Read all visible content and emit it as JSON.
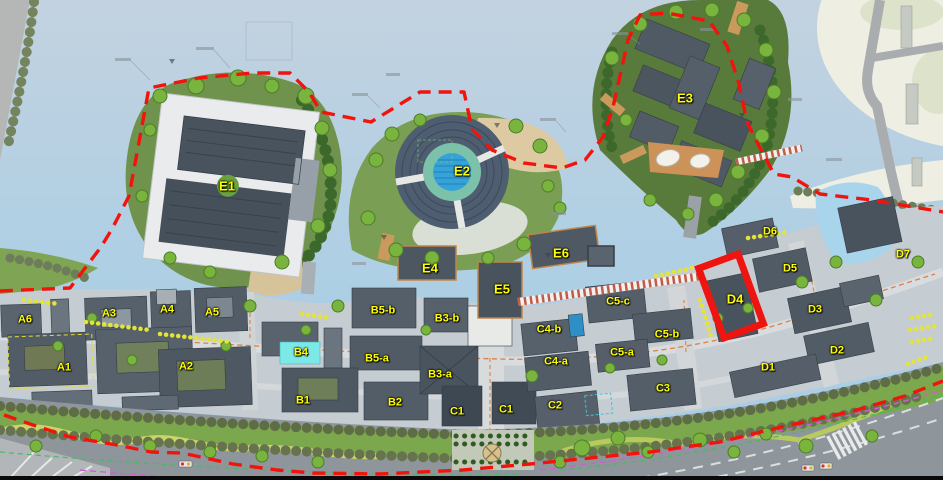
{
  "map": {
    "type": "architectural-master-plan",
    "highlighted_parcel": "D4",
    "boundary_style": "red-dashed-line",
    "colors": {
      "water": "#b7cee0",
      "label_yellow": "#ffff00",
      "boundary_red": "#f2130c",
      "highlight_red": "#ee1410",
      "b4_roof_cyan": "#7de9e6",
      "open_field_cream": "#efeee3",
      "island_green": "#6f934c",
      "building_slate": "#515b66"
    },
    "parcel_labels": [
      {
        "text": "A6",
        "x": 25,
        "y": 320,
        "size": "normal"
      },
      {
        "text": "A3",
        "x": 109,
        "y": 314,
        "size": "normal"
      },
      {
        "text": "A4",
        "x": 167,
        "y": 310,
        "size": "normal"
      },
      {
        "text": "A5",
        "x": 212,
        "y": 313,
        "size": "normal"
      },
      {
        "text": "A1",
        "x": 64,
        "y": 368,
        "size": "normal"
      },
      {
        "text": "A2",
        "x": 186,
        "y": 367,
        "size": "normal"
      },
      {
        "text": "B4",
        "x": 301,
        "y": 353,
        "size": "normal"
      },
      {
        "text": "B5-b",
        "x": 383,
        "y": 311,
        "size": "normal"
      },
      {
        "text": "B5-a",
        "x": 377,
        "y": 359,
        "size": "normal"
      },
      {
        "text": "B3-b",
        "x": 447,
        "y": 319,
        "size": "normal"
      },
      {
        "text": "B3-a",
        "x": 440,
        "y": 375,
        "size": "normal"
      },
      {
        "text": "B1",
        "x": 303,
        "y": 401,
        "size": "normal"
      },
      {
        "text": "B2",
        "x": 395,
        "y": 403,
        "size": "normal"
      },
      {
        "text": "C1",
        "x": 457,
        "y": 412,
        "size": "normal"
      },
      {
        "text": "C1",
        "x": 506,
        "y": 410,
        "size": "normal"
      },
      {
        "text": "C2",
        "x": 555,
        "y": 406,
        "size": "normal"
      },
      {
        "text": "C4-b",
        "x": 549,
        "y": 330,
        "size": "normal"
      },
      {
        "text": "C4-a",
        "x": 556,
        "y": 362,
        "size": "normal"
      },
      {
        "text": "C5-c",
        "x": 618,
        "y": 302,
        "size": "normal"
      },
      {
        "text": "C5-b",
        "x": 667,
        "y": 335,
        "size": "normal"
      },
      {
        "text": "C5-a",
        "x": 622,
        "y": 353,
        "size": "normal"
      },
      {
        "text": "C3",
        "x": 663,
        "y": 389,
        "size": "normal"
      },
      {
        "text": "D1",
        "x": 768,
        "y": 368,
        "size": "normal"
      },
      {
        "text": "D2",
        "x": 837,
        "y": 351,
        "size": "normal"
      },
      {
        "text": "D3",
        "x": 815,
        "y": 310,
        "size": "normal"
      },
      {
        "text": "D4",
        "x": 735,
        "y": 299,
        "size": "big"
      },
      {
        "text": "D5",
        "x": 790,
        "y": 269,
        "size": "normal"
      },
      {
        "text": "D6",
        "x": 770,
        "y": 232,
        "size": "normal"
      },
      {
        "text": "D7",
        "x": 903,
        "y": 255,
        "size": "normal"
      },
      {
        "text": "E1",
        "x": 227,
        "y": 186,
        "size": "big"
      },
      {
        "text": "E2",
        "x": 462,
        "y": 171,
        "size": "big"
      },
      {
        "text": "E3",
        "x": 685,
        "y": 98,
        "size": "big"
      },
      {
        "text": "E4",
        "x": 430,
        "y": 268,
        "size": "big"
      },
      {
        "text": "E5",
        "x": 502,
        "y": 289,
        "size": "big"
      },
      {
        "text": "E6",
        "x": 561,
        "y": 253,
        "size": "big"
      }
    ]
  }
}
